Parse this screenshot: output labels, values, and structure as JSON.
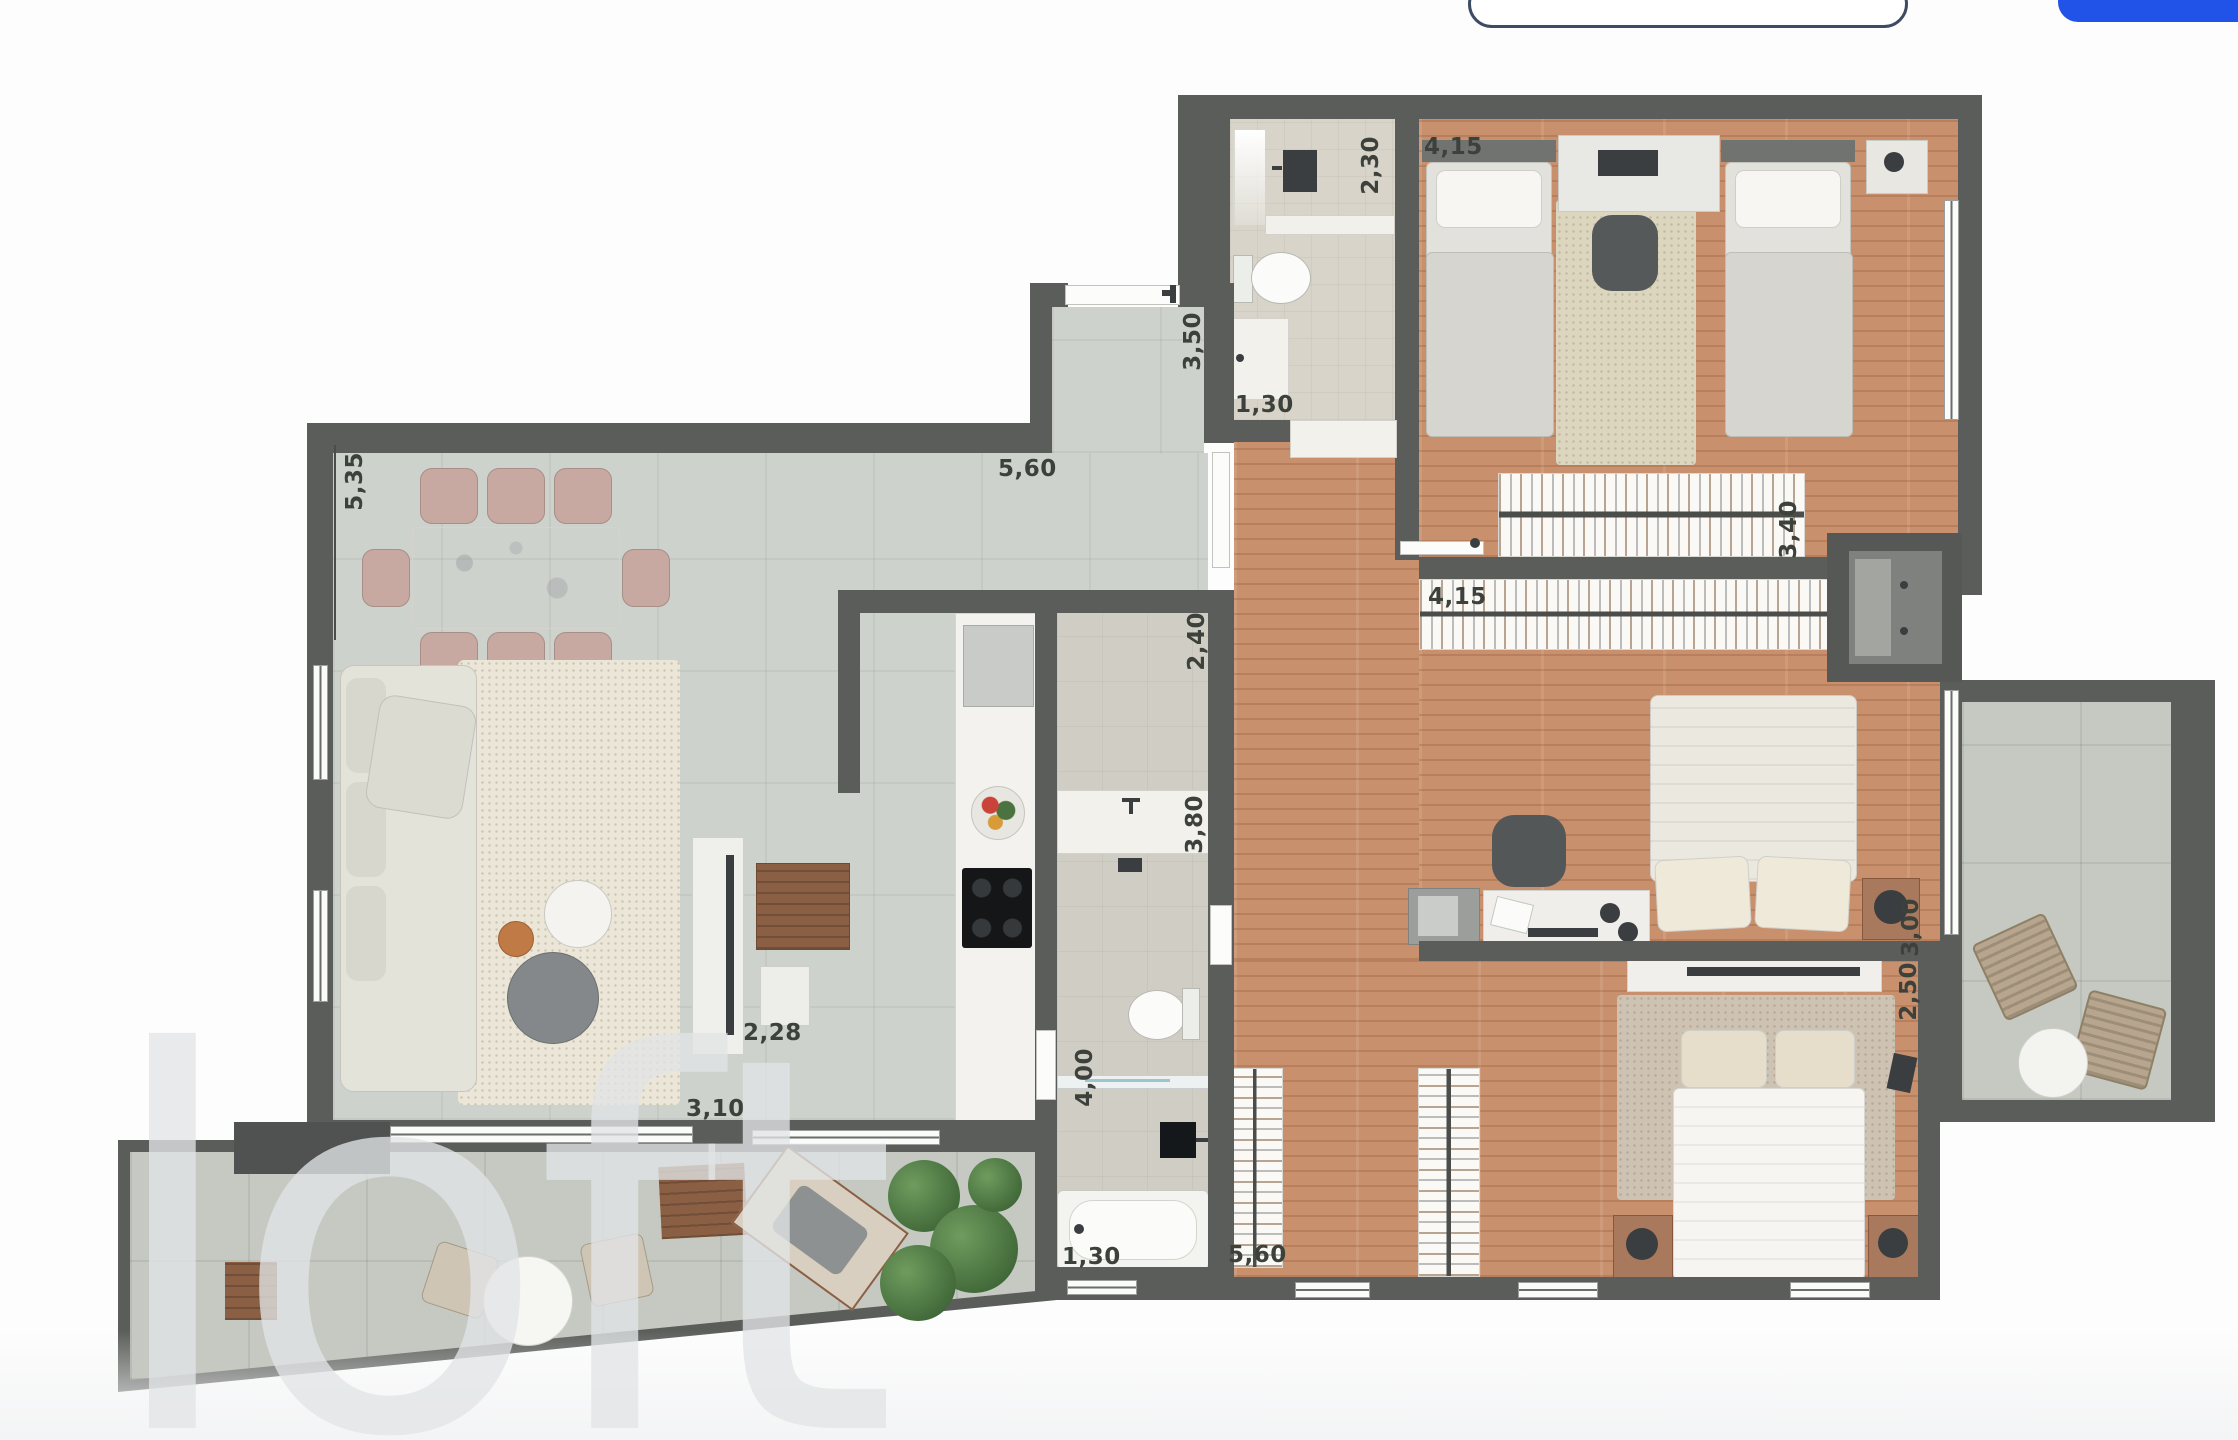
{
  "title": "apartment-floor-plan",
  "watermark": {
    "text": "loft"
  },
  "header": {
    "outline_button_label": "",
    "primary_button_label": "",
    "primary_color": "#2153e8"
  },
  "dims": {
    "d535": "5,35",
    "d560a": "5,60",
    "d230": "2,30",
    "d415a": "4,15",
    "d350": "3,50",
    "d130a": "1,30",
    "d340": "3,40",
    "d415b": "4,15",
    "d240": "2,40",
    "d380": "3,80",
    "d400": "4,00",
    "d228": "2,28",
    "d310": "3,10",
    "d130b": "1,30",
    "d560b": "5,60",
    "d300": "3,00",
    "d250": "2,50"
  },
  "colors": {
    "wall": "#5b5d5a",
    "wood_floor": "#c8906c",
    "tile_floor": "#ced2cc",
    "balcony_tile": "#c5c9c2",
    "bath_floor": "#d8d4c9",
    "accent_blue": "#2153e8",
    "watermark_gray": "#e1e4e5"
  }
}
